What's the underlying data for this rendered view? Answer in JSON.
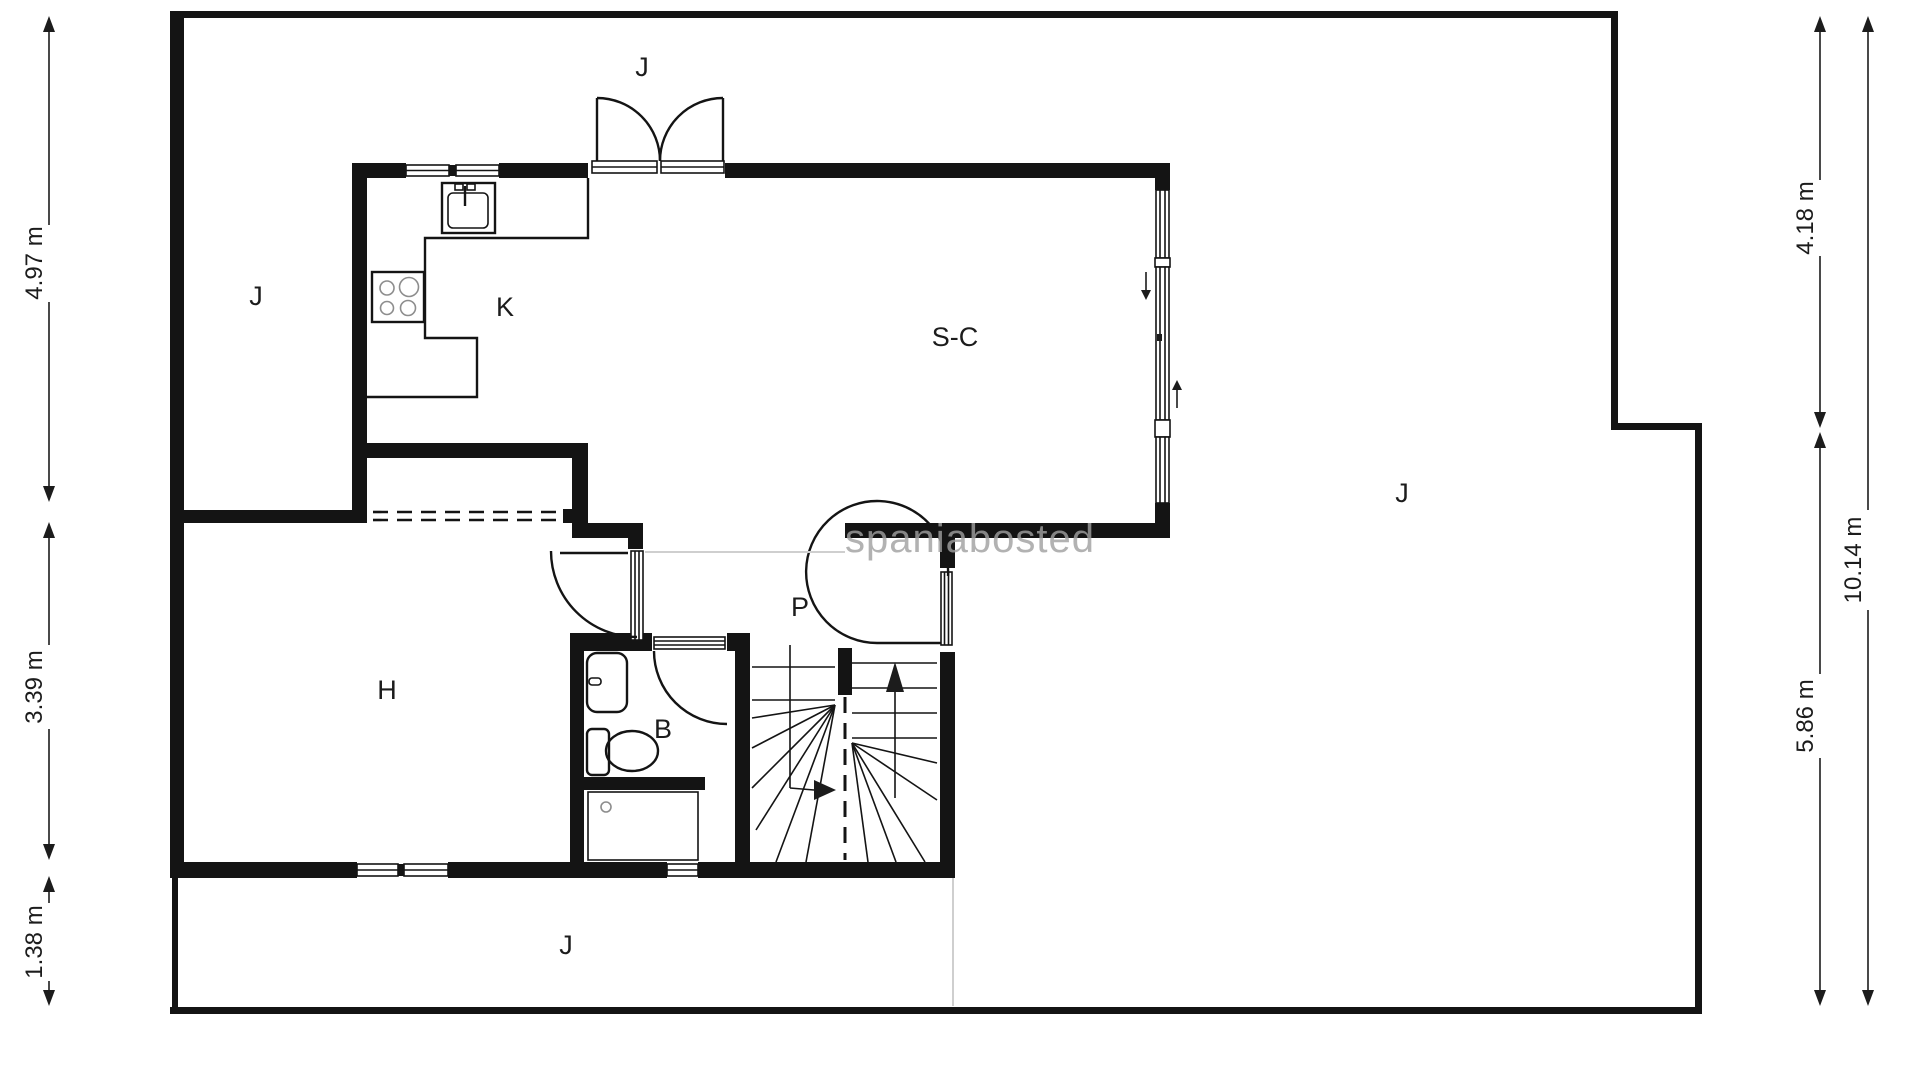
{
  "watermark": "spaniabosted",
  "rooms": {
    "kitchen": "K",
    "living_dining": "S-C",
    "hall": "H",
    "bathroom": "B",
    "passage": "P"
  },
  "garden": {
    "top": "J",
    "left": "J",
    "right": "J",
    "bottom": "J"
  },
  "dimensions": {
    "left_top": "4.97 m",
    "left_middle": "3.39 m",
    "left_bottom": "1.38 m",
    "right_upper": "4.18 m",
    "right_lower": "5.86 m",
    "right_total": "10.14 m"
  },
  "colors": {
    "walls": "#141414",
    "background": "#ffffff",
    "light_lines": "#cfcfcf",
    "watermark": "#a0a0a0"
  }
}
